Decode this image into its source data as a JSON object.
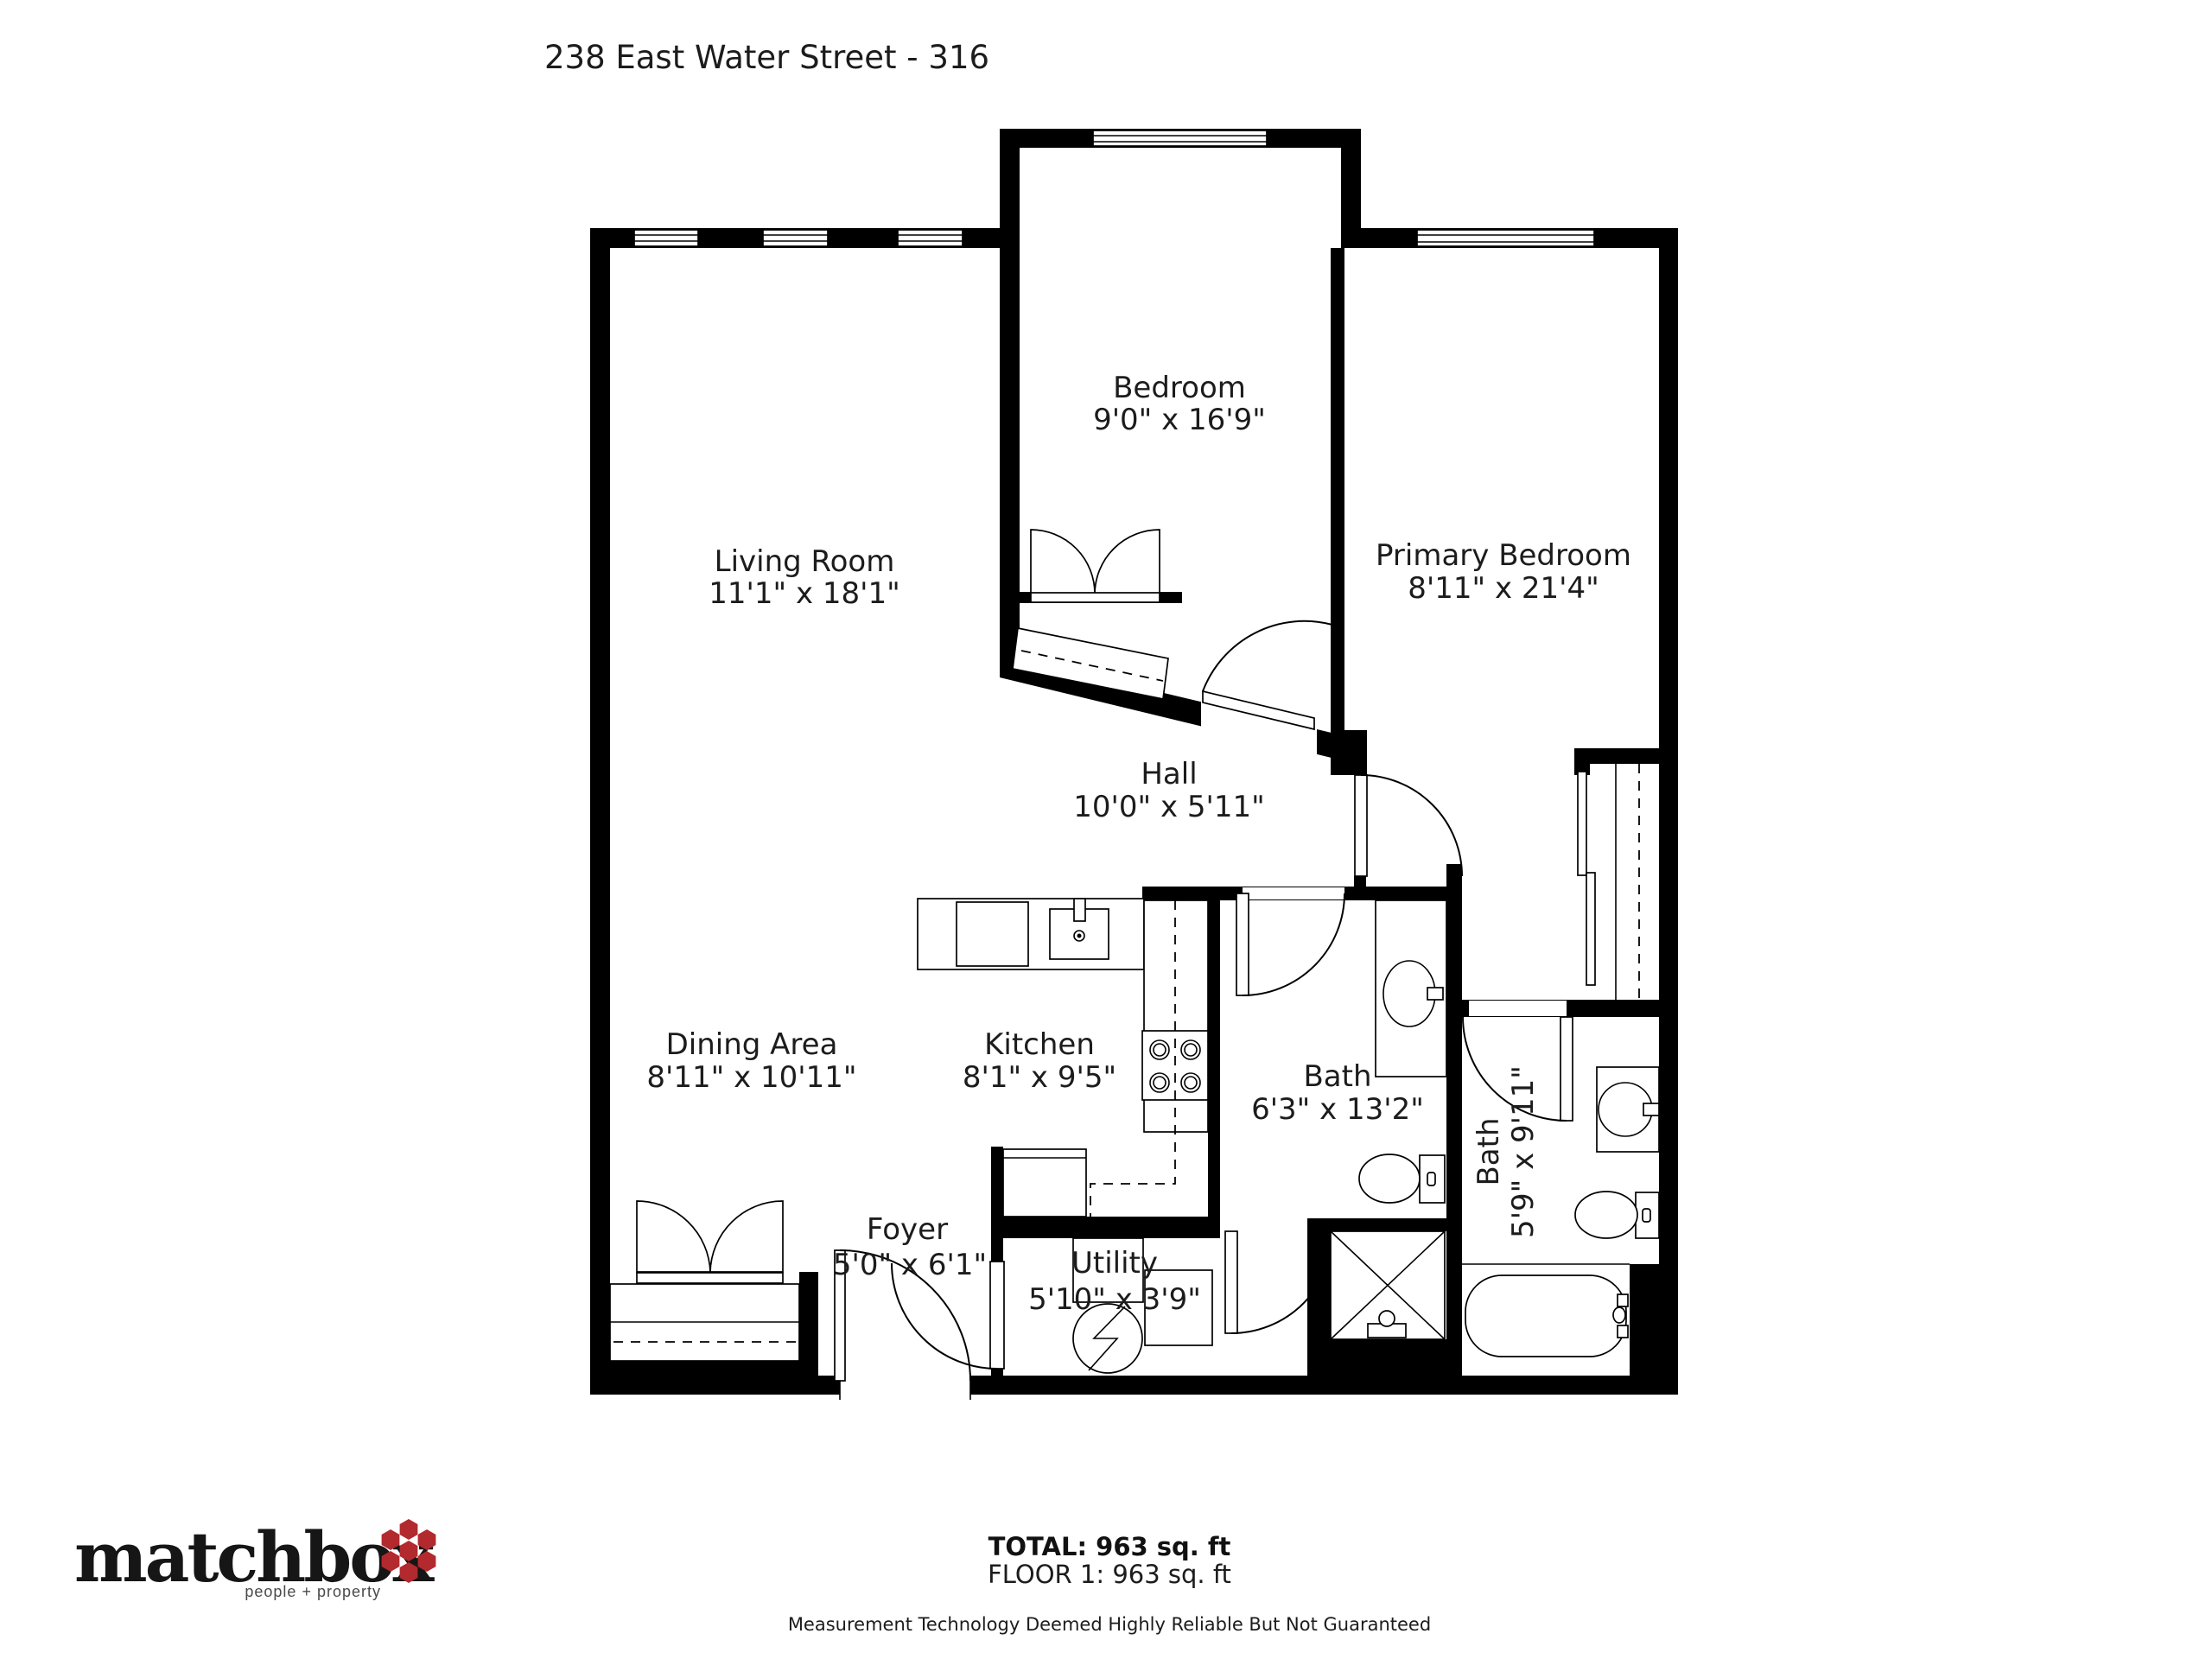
{
  "title": "238 East Water Street - 316",
  "rooms": {
    "bedroom": {
      "name": "Bedroom",
      "dims": "9'0\" x 16'9\""
    },
    "living_room": {
      "name": "Living Room",
      "dims": "11'1\" x 18'1\""
    },
    "primary_bedroom": {
      "name": "Primary Bedroom",
      "dims": "8'11\" x 21'4\""
    },
    "hall": {
      "name": "Hall",
      "dims": "10'0\" x 5'11\""
    },
    "dining_area": {
      "name": "Dining Area",
      "dims": "8'11\" x 10'11\""
    },
    "kitchen": {
      "name": "Kitchen",
      "dims": "8'1\" x 9'5\""
    },
    "bath": {
      "name": "Bath",
      "dims": "6'3\" x 13'2\""
    },
    "bath_2": {
      "name": "Bath",
      "dims": "5'9\" x 9'11\""
    },
    "foyer": {
      "name": "Foyer",
      "dims": "5'0\" x 6'1\""
    },
    "utility": {
      "name": "Utility",
      "dims": "5'10\" x 3'9\""
    }
  },
  "footer": {
    "total": "TOTAL: 963 sq. ft",
    "floor": "FLOOR 1: 963 sq. ft",
    "disclaimer": "Measurement Technology Deemed Highly Reliable But Not Guaranteed"
  },
  "logo": {
    "brand": "matchbox",
    "tagline": "people + property",
    "hex_color": "#b2292e"
  }
}
